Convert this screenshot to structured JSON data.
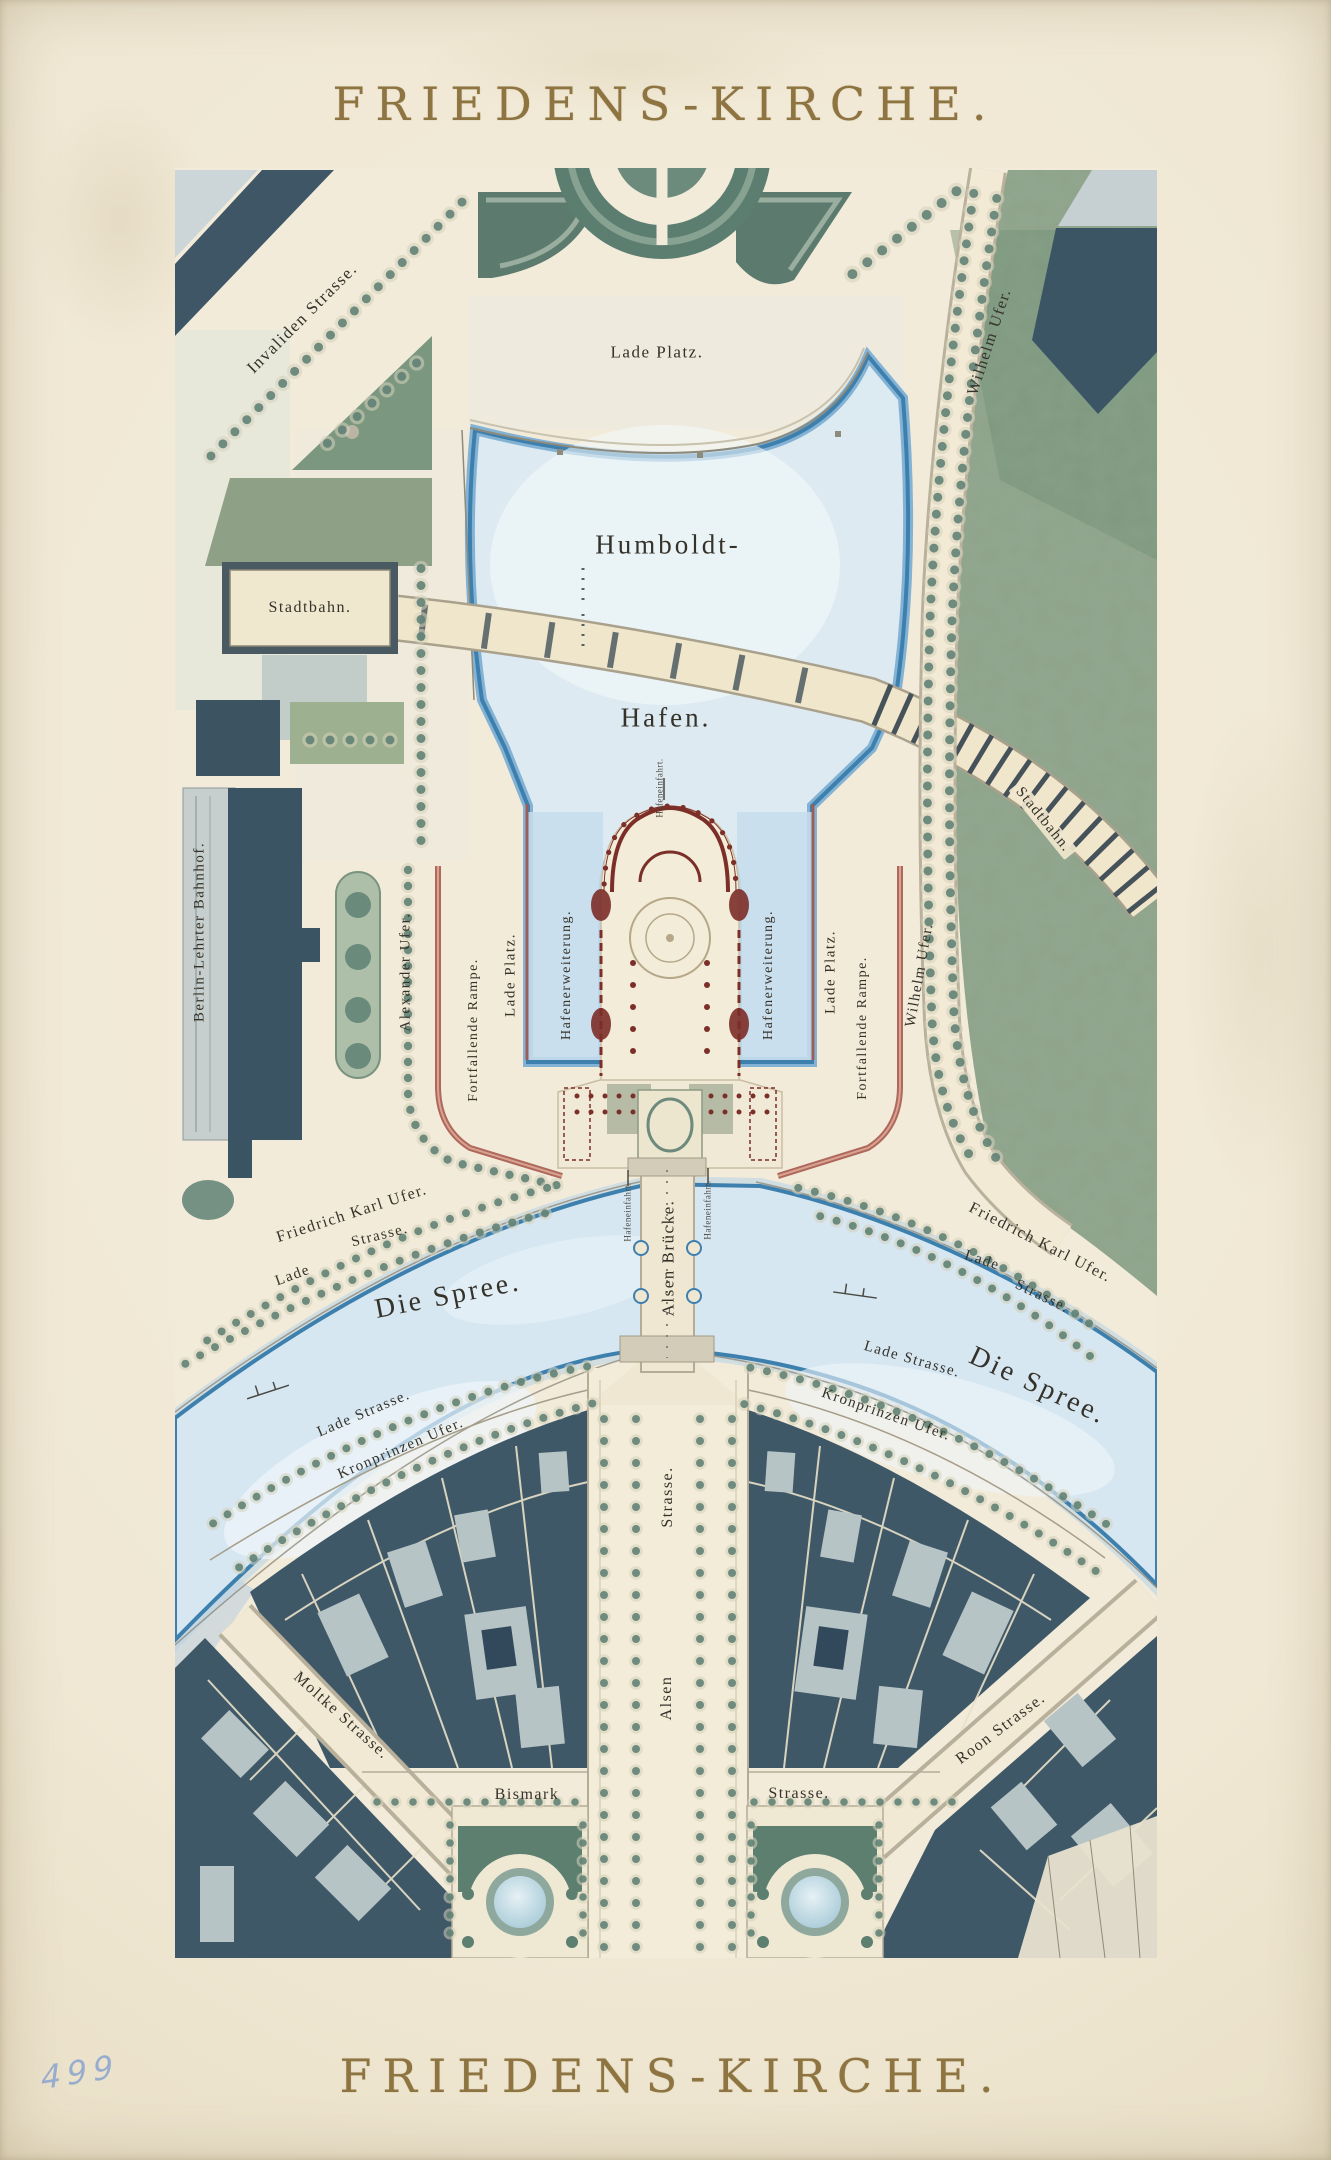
{
  "titles": {
    "top": "FRIEDENS-KIRCHE.",
    "bottom": "FRIEDENS-KIRCHE."
  },
  "annotation": {
    "number": "499"
  },
  "map": {
    "labels": {
      "invaliden_strasse": "Invaliden Strasse.",
      "lade_platz_north": "Lade Platz.",
      "wilhelm_ufer_north": "Wilhelm Ufer.",
      "stadtbahn_station": "Stadtbahn.",
      "humboldt": "Humboldt-",
      "hafen": "Hafen.",
      "stadtbahn_viaduct": "Stadtbahn.",
      "berlin_lehrter_bahnhof": "Berlin-Lehrter Bahnhof.",
      "alexander_ufer": "Alexander Ufer.",
      "fortfallende_rampe_west": "Fortfallende Rampe.",
      "lade_platz_west": "Lade Platz.",
      "hafenerweiterung_west": "Hafenerweiterung.",
      "hafenerweiterung_east": "Hafenerweiterung.",
      "lade_platz_east": "Lade Platz.",
      "fortfallende_rampe_east": "Fortfallende Rampe.",
      "wilhelm_ufer_east": "Wilhelm Ufer.",
      "hafeneinfahrt_north": "Hafeneinfahrt.",
      "hafeneinfahrt_west": "Hafeneinfahrt.",
      "hafeneinfahrt_east": "Hafeneinfahrt.",
      "friedrich_karl_ufer_west": "Friedrich Karl Ufer.",
      "lade_west": "Lade",
      "strasse_west": "Strasse.",
      "die_spree_west": "Die Spree.",
      "alsen_bruecke": "Alsen Brücke.",
      "friedrich_karl_ufer_east": "Friedrich Karl Ufer.",
      "lade_east": "Lade",
      "strasse_east": "Strasse.",
      "die_spree_east": "Die Spree.",
      "lade_strasse_sw": "Lade Strasse.",
      "kronprinzen_ufer_west": "Kronprinzen Ufer.",
      "lade_strasse_se": "Lade Strasse.",
      "kronprinzen_ufer_east": "Kronprinzen Ufer.",
      "alsen_strasse_part2": "Strasse.",
      "alsen_strasse_part1": "Alsen",
      "moltke_strasse": "Moltke Strasse.",
      "bismark": "Bismark",
      "bismark_strasse_part2": "Strasse.",
      "roon_strasse": "Roon Strasse."
    },
    "colors": {
      "paper": "#f2ebd9",
      "water_fill": "#dceaf3",
      "water_edge": "#3d80ae",
      "park_green": "#8fa38a",
      "building_slate": "#3f5868",
      "church_maroon": "#7c2e28",
      "ramp_red": "#a65a4f",
      "tree_green": "#5d7f73",
      "title_gold": "#8d7440",
      "label_ink": "#35322a"
    }
  }
}
